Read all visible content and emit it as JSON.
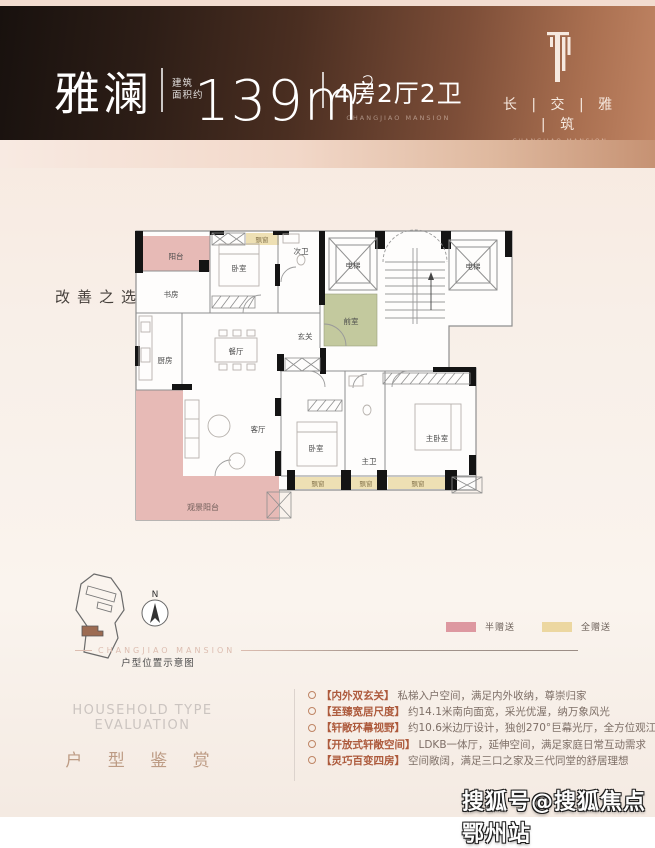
{
  "header": {
    "unit_name": "雅澜",
    "area_prefix_line1": "建筑",
    "area_prefix_line2": "面积约",
    "area_value": "139m",
    "area_sup": "2",
    "layout": "4房2厅2卫",
    "layout_sub": "CHANGJIAO MANSION",
    "brand_cn": "长 | 交 | 雅 | 筑",
    "brand_en": "CHANGJIAO MANSION"
  },
  "tagline": "改善之选 ＆ 观江雅居",
  "floor_plan": {
    "rooms": [
      "阳台",
      "书房",
      "卧室",
      "飘窗",
      "次卫",
      "电梯",
      "电梯",
      "前室",
      "玄关",
      "餐厅",
      "厨房",
      "客厅",
      "观景阳台",
      "卧室",
      "主卫",
      "主卧室",
      "飘窗",
      "飘窗",
      "飘窗"
    ]
  },
  "site_plan": {
    "compass_label": "N",
    "caption": "户型位置示意图",
    "divider_text": "CHANGJIAO MANSION"
  },
  "legend": {
    "items": [
      {
        "label": "半赠送",
        "color": "#dd98a0"
      },
      {
        "label": "全赠送",
        "color": "#ecd7a0"
      }
    ]
  },
  "evaluation": {
    "title_en": "HOUSEHOLD TYPE EVALUATION",
    "title_cn": "户 型 鉴 赏",
    "points": [
      {
        "tag": "【内外双玄关】",
        "desc": "私梯入户空间，满足内外收纳，尊崇归家"
      },
      {
        "tag": "【至臻宽居尺度】",
        "desc": "约14.1米南向面宽，采光优渥，纳万象风光"
      },
      {
        "tag": "【轩敞环幕视野】",
        "desc": "约10.6米边厅设计，独创270°巨幕光厅，全方位观江"
      },
      {
        "tag": "【开放式轩敞空间】",
        "desc": "LDKB一体厅，延伸空间，满足家庭日常互动需求"
      },
      {
        "tag": "【灵巧百变四房】",
        "desc": "空间敞阔，满足三口之家及三代同堂的舒居理想"
      }
    ]
  },
  "watermark": "搜狐号@搜狐焦点鄂州站",
  "colors": {
    "room_pink": "#e7bab6",
    "room_green": "#c3c99e",
    "bay_beige": "#eee0b4"
  }
}
